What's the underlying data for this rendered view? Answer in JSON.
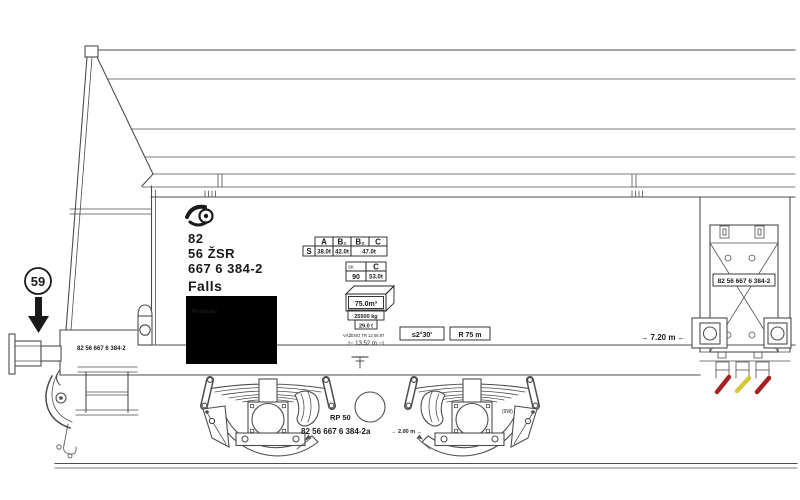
{
  "drawing": {
    "background": "#ffffff",
    "stroke_color": "#4d4d4d",
    "ink_color": "#1a1a1a",
    "route_marker": {
      "number": "59"
    },
    "owner_block": {
      "line1": "82",
      "line2": "56 ŽSR",
      "line3": "667 6 384-2",
      "class_name": "Falls"
    },
    "label_panel": {
      "title": "Přechodky",
      "bg": "#000000",
      "text_color": "#ffffff"
    },
    "load_limit_table": {
      "columns": [
        "A",
        "B₁",
        "B₂",
        "C"
      ],
      "row_label": "S",
      "loads": [
        "38.0t",
        "42.0t",
        "47.0t"
      ]
    },
    "sk_table": {
      "country": "SK",
      "column": "C",
      "speed": "90",
      "load": "53.0t"
    },
    "volume_box": {
      "value": "75.0m³"
    },
    "tare_box": {
      "line1": "25500 kg",
      "line2": "29.0 t"
    },
    "weighing_note": "VÁŽENO TR 12.06.97",
    "length_note": "⊢ 13.52 m ⊣",
    "signs": {
      "angle": "≤2°30'",
      "radius": "R 75 m"
    },
    "frame_number_left": "82 56 667 6 384-2",
    "center_panel_number": "82 56 667 6 384-2",
    "pivot_dim": "→ 7.20 m ←",
    "bogie": {
      "brake": "RP 50",
      "note": "(9W)",
      "number": "82 56 667 6 384-2a",
      "wheelbase": "→ 2.00 m ←"
    },
    "handle_colors": {
      "red": "#a62323",
      "yellow": "#d4c83e"
    }
  }
}
